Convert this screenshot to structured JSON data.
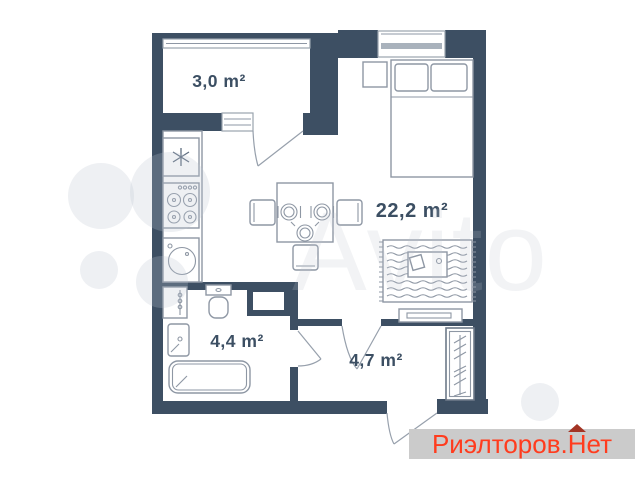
{
  "watermark": {
    "text": "Avito"
  },
  "rooms": {
    "balcony": {
      "label": "3,0 m²"
    },
    "living": {
      "label": "22,2 m²"
    },
    "bathroom": {
      "label": "4,4 m²"
    },
    "hallway": {
      "label": "4,7 m²"
    }
  },
  "branding": {
    "prefix": "Риэлторов.",
    "house_letter": "Н",
    "suffix": "ет"
  },
  "colors": {
    "wall": "#3d4f63",
    "furniture_line": "#8e97a4",
    "label_text": "#3c4f63",
    "brand_text": "#ff3c1e",
    "brand_roof": "#a33424",
    "brand_bar_bg": "#cbcbcb",
    "watermark_tint": "#bcc4ce"
  }
}
